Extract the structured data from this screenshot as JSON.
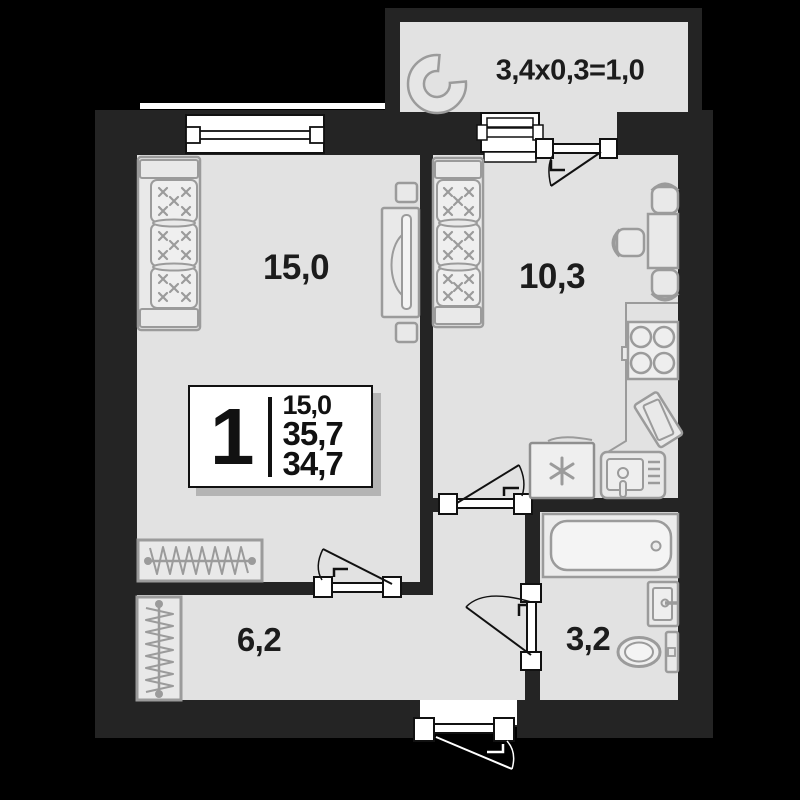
{
  "page": {
    "type": "apartment-floor-plan"
  },
  "rooms": {
    "living": {
      "label": "15,0"
    },
    "kitchen": {
      "label": "10,3"
    },
    "hallway": {
      "label": "6,2"
    },
    "bathroom": {
      "label": "3,2"
    },
    "balcony": {
      "label": "3,4x0,3=1,0"
    }
  },
  "info_box": {
    "number": "1",
    "living_area": "15,0",
    "total_area": "35,7",
    "reduced_area": "34,7"
  },
  "colors": {
    "background": "#000000",
    "wall": "#242424",
    "floor": "#e2e2e2",
    "furniture_outline": "#9b9b9b",
    "frame_dark": "#111111",
    "white": "#ffffff",
    "text": "#1c1c1c",
    "shadow": "#b4b4b4"
  },
  "icons": {
    "sofa": "sofa-icon",
    "tv": "tv-icon",
    "wardrobe": "wardrobe-icon",
    "dining_table": "dining-table-icon",
    "chair": "chair-icon",
    "stove": "stove-icon",
    "fridge": "fridge-icon",
    "kitchen_sink": "kitchen-sink-icon",
    "cutting_board": "cutting-board-icon",
    "bathtub": "bathtub-icon",
    "washbasin": "washbasin-icon",
    "toilet": "toilet-icon",
    "door": "door-icon",
    "window": "window-icon",
    "balcony_unit": "balcony-unit-icon"
  }
}
